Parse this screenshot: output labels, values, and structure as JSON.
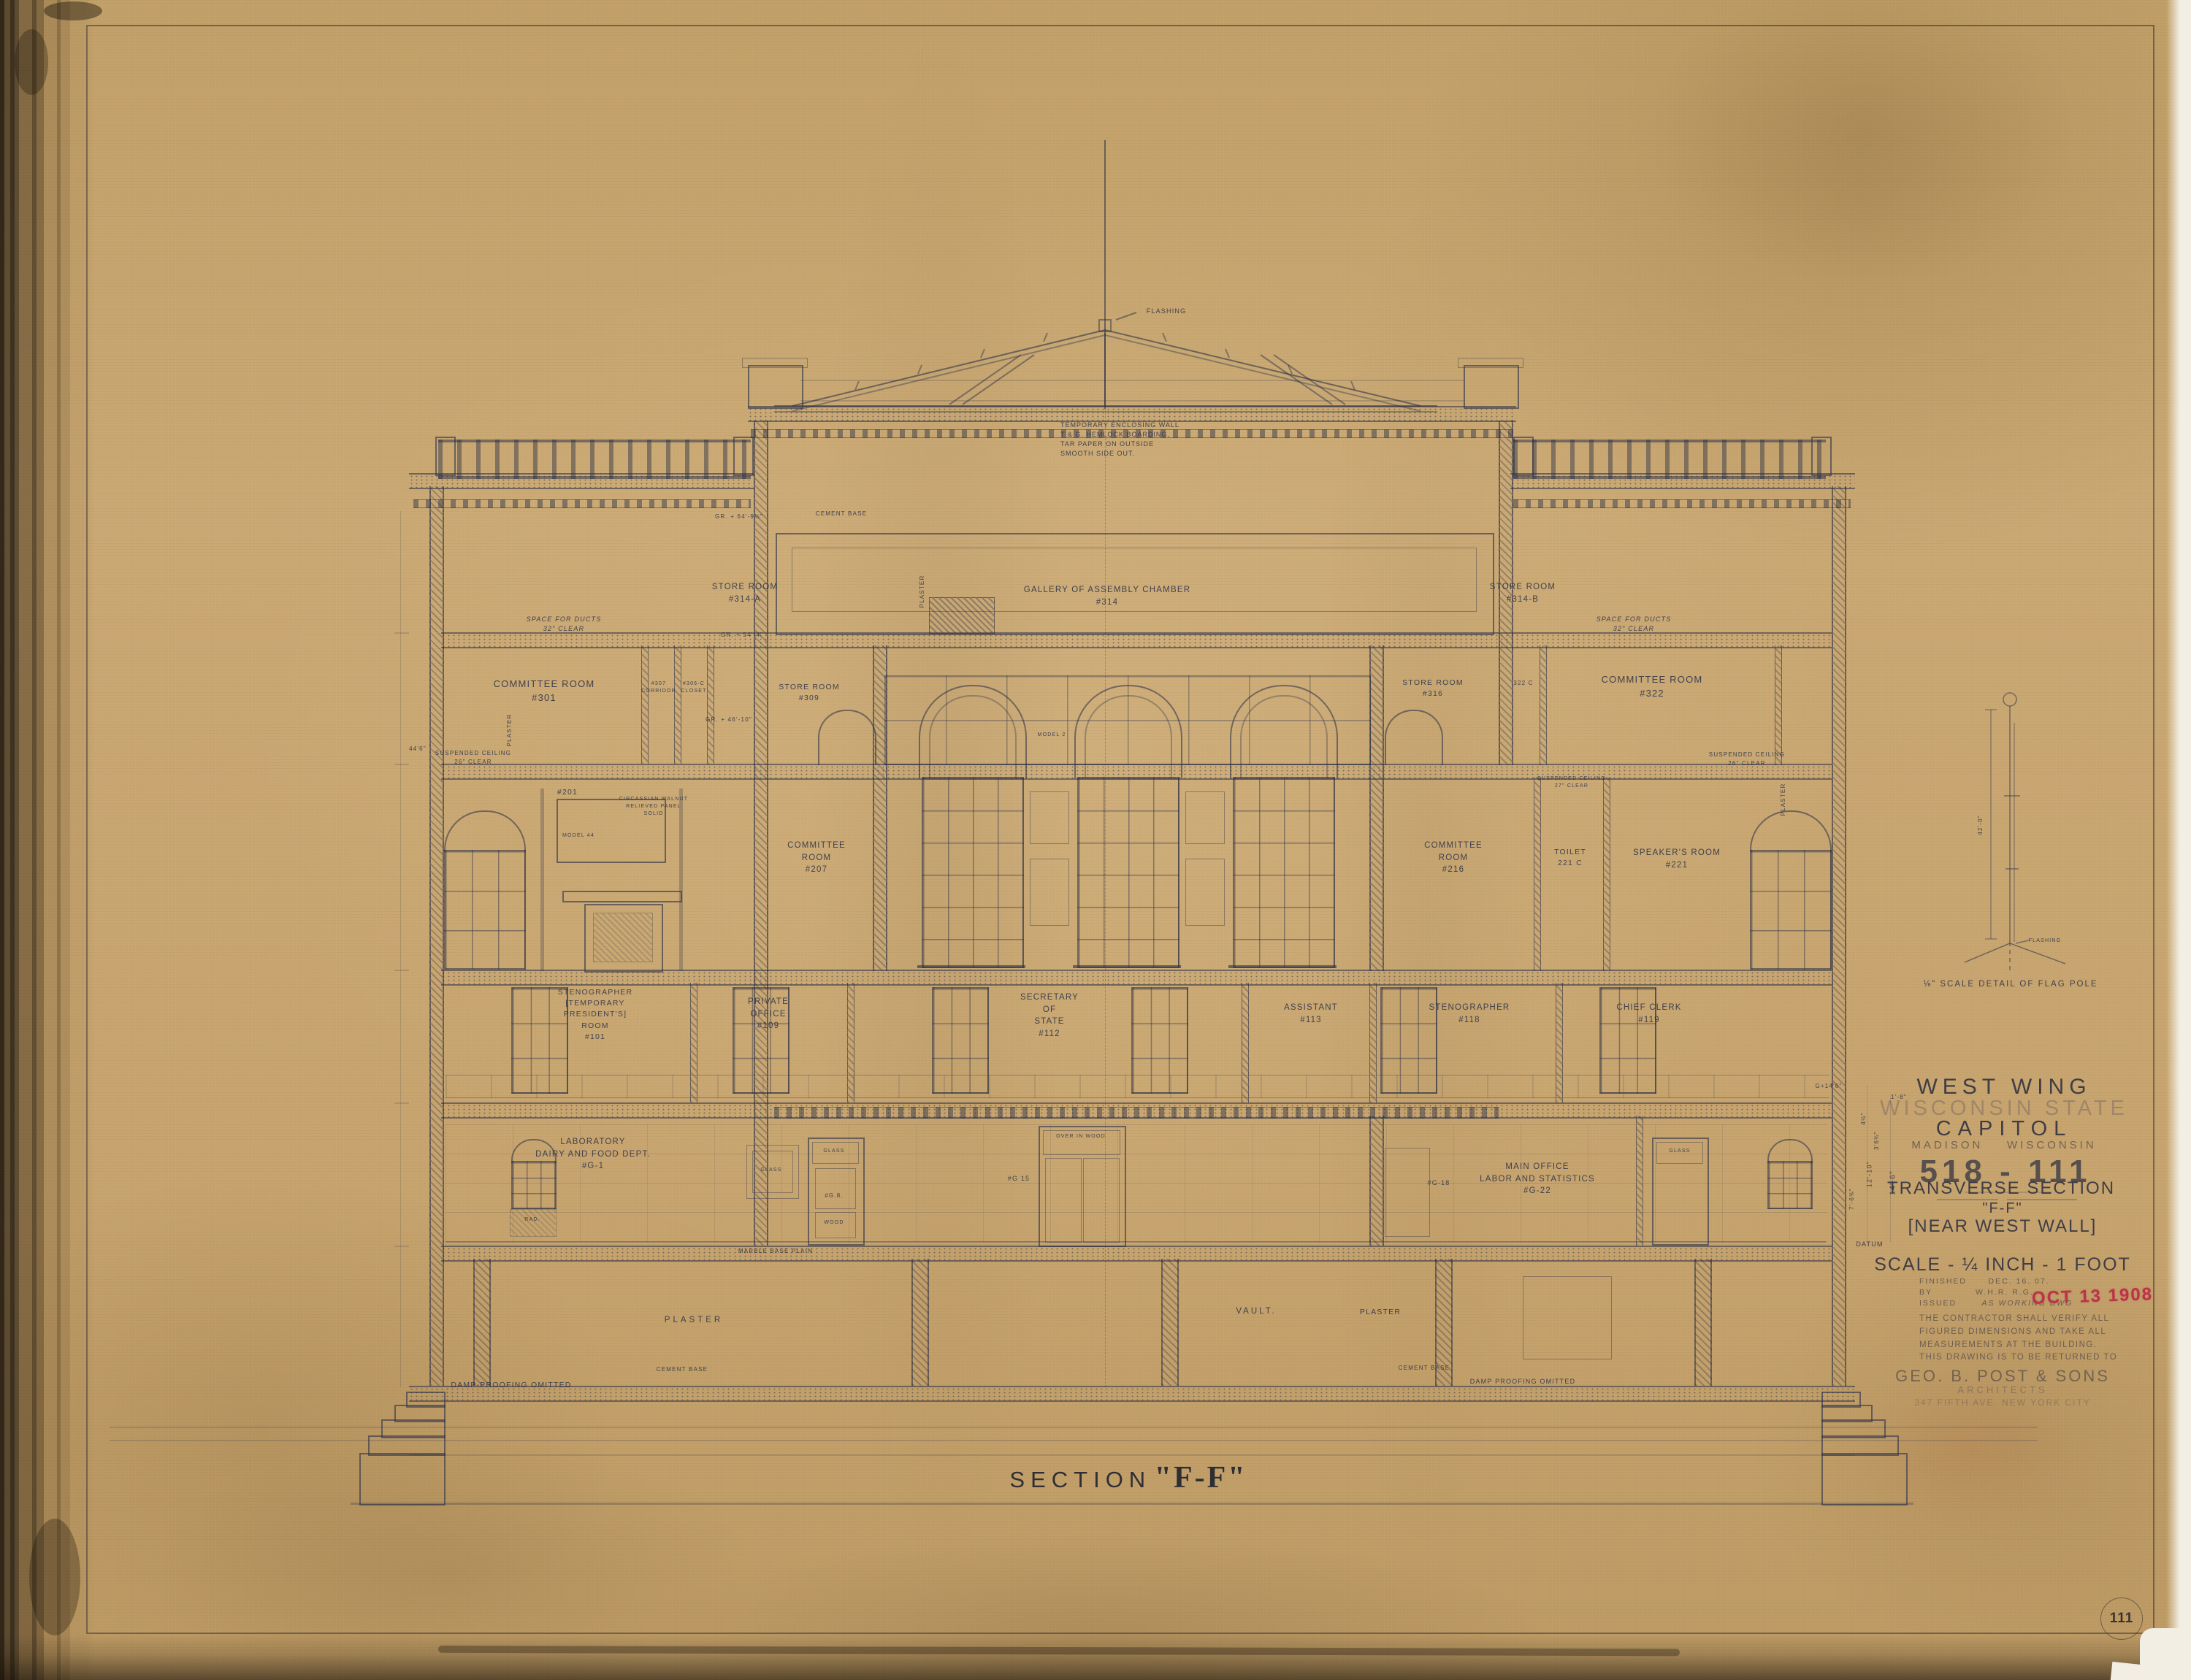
{
  "colors": {
    "paper": "#c7a46e",
    "ink": "#2a304a",
    "stamp_red": "#bc3348"
  },
  "caption": {
    "w": "SECTION",
    "n": "\"F-F\""
  },
  "sheetno": "111",
  "titleblock": {
    "project": "WEST WING",
    "state": "WISCONSIN STATE",
    "capitol": "CAPITOL",
    "city": "MADISON",
    "state2": "WISCONSIN",
    "number": "518 - 111",
    "t1": "TRANSVERSE SECTION",
    "t2": "\"F-F\"",
    "t3": "[NEAR WEST WALL]",
    "scale": "SCALE - ¼ INCH - 1 FOOT",
    "finished_l": "FINISHED",
    "finished_v": "DEC. 16. 07.",
    "by_l": "BY",
    "by_v": "W.H.R.  R.G.",
    "issued_l": "ISSUED",
    "issued_v": "AS WORKING DWG",
    "stamp": "OCT 13 1908",
    "note": [
      "THE CONTRACTOR SHALL VERIFY ALL",
      "FIGURED DIMENSIONS AND TAKE ALL",
      "MEASUREMENTS AT THE BUILDING.",
      "THIS DRAWING IS TO BE RETURNED TO"
    ],
    "firm": "GEO. B. POST & SONS",
    "role": "ARCHITECTS",
    "address": "347 FIFTH AVE.  NEW YORK CITY"
  },
  "flag": {
    "caption": "⅛\" SCALE DETAIL OF FLAG POLE",
    "dim": "42'-0\"",
    "flashing": "FLASHING"
  },
  "labels": {
    "encl": {
      "lines": [
        "TEMPORARY ENCLOSING WALL",
        "T & G. HEMLOCK BOARDING,",
        "TAR PAPER ON OUTSIDE",
        "SMOOTH SIDE OUT."
      ]
    },
    "store_a": {
      "lines": [
        "STORE ROOM",
        "#314-A"
      ]
    },
    "gallery": {
      "lines": [
        "GALLERY OF ASSEMBLY CHAMBER",
        "#314"
      ]
    },
    "store_b": {
      "lines": [
        "STORE ROOM",
        "#314-B"
      ]
    },
    "c301": {
      "lines": [
        "COMMITTEE ROOM",
        "#301"
      ]
    },
    "c307": {
      "lines": [
        "#307",
        "CORRIDOR"
      ]
    },
    "c306": {
      "lines": [
        "#306-C",
        "CLOSET"
      ]
    },
    "s309": {
      "lines": [
        "STORE ROOM",
        "#309"
      ]
    },
    "s316": {
      "lines": [
        "STORE ROOM",
        "#316"
      ]
    },
    "c322c": {
      "lines": [
        "322 C"
      ]
    },
    "c322": {
      "lines": [
        "COMMITTEE ROOM",
        "#322"
      ]
    },
    "r201": {
      "lines": [
        "#201"
      ]
    },
    "c207": {
      "lines": [
        "COMMITTEE",
        "ROOM",
        "#207"
      ]
    },
    "c216": {
      "lines": [
        "COMMITTEE",
        "ROOM",
        "#216"
      ]
    },
    "t221": {
      "lines": [
        "TOILET",
        "221 C"
      ]
    },
    "sp221": {
      "lines": [
        "SPEAKER'S ROOM",
        "#221"
      ]
    },
    "r101": {
      "lines": [
        "STENOGRAPHER",
        "[TEMPORARY",
        "PRESIDENT'S]",
        "ROOM",
        "#101"
      ]
    },
    "r109": {
      "lines": [
        "PRIVATE",
        "OFFICE",
        "#109"
      ]
    },
    "r112": {
      "lines": [
        "SECRETARY",
        "OF",
        "STATE",
        "#112"
      ]
    },
    "r113": {
      "lines": [
        "ASSISTANT",
        "#113"
      ]
    },
    "r118": {
      "lines": [
        "STENOGRAPHER",
        "#118"
      ]
    },
    "r119": {
      "lines": [
        "CHIEF CLERK",
        "#119"
      ]
    },
    "g1": {
      "lines": [
        "LABORATORY",
        "DAIRY AND FOOD DEPT.",
        "#G-1"
      ]
    },
    "g15": {
      "lines": [
        "#G 15"
      ]
    },
    "g18": {
      "lines": [
        "#G-18"
      ]
    },
    "g22": {
      "lines": [
        "MAIN OFFICE",
        "LABOR AND STATISTICS",
        "#G-22"
      ]
    },
    "vault": {
      "lines": [
        "VAULT."
      ]
    },
    "ducts": {
      "lines": [
        "SPACE FOR DUCTS",
        "32\" CLEAR"
      ]
    },
    "susp26": {
      "lines": [
        "SUSPENDED CEILING",
        "26\" CLEAR"
      ]
    },
    "susp27": {
      "lines": [
        "SUSPENDED CEILING",
        "27\" CLEAR"
      ]
    },
    "walnut": {
      "lines": [
        "CIRCASSIAN WALNUT",
        "RELIEVED PANEL",
        "SOLID"
      ]
    },
    "vent": {
      "lines": [
        "VENTILATOR",
        "OVER IN WOOD"
      ]
    }
  },
  "misc": {
    "flashing": "FLASHING",
    "model2": "MODEL 2",
    "model44": "MODEL 44",
    "plaster": "PLASTER",
    "glass": "GLASS",
    "wood": "WOOD",
    "rad": "RAD.",
    "g8": "#G.8.",
    "cement": "CEMENT BASE",
    "marble": "MARBLE BASE PLAIN",
    "damp_l": "DAMP-PROOFING OMITTED",
    "damp_r": "DAMP PROOFING OMITTED"
  },
  "levels": {
    "l64": "GR. + 64'-9½\"",
    "l54": "GR. + 54'-4\"",
    "l46": "GR. + 46'-10\""
  },
  "dims": {
    "d44": "44'6\"",
    "g14": "G+14'6\"",
    "i18": "1'-8\"",
    "i45": "4½\"",
    "i36": "3'6¾\"",
    "i76": "7'-6⅝\"",
    "i1210": "12'-10\"",
    "i146": "14'-6\"",
    "datum": "DATUM"
  }
}
